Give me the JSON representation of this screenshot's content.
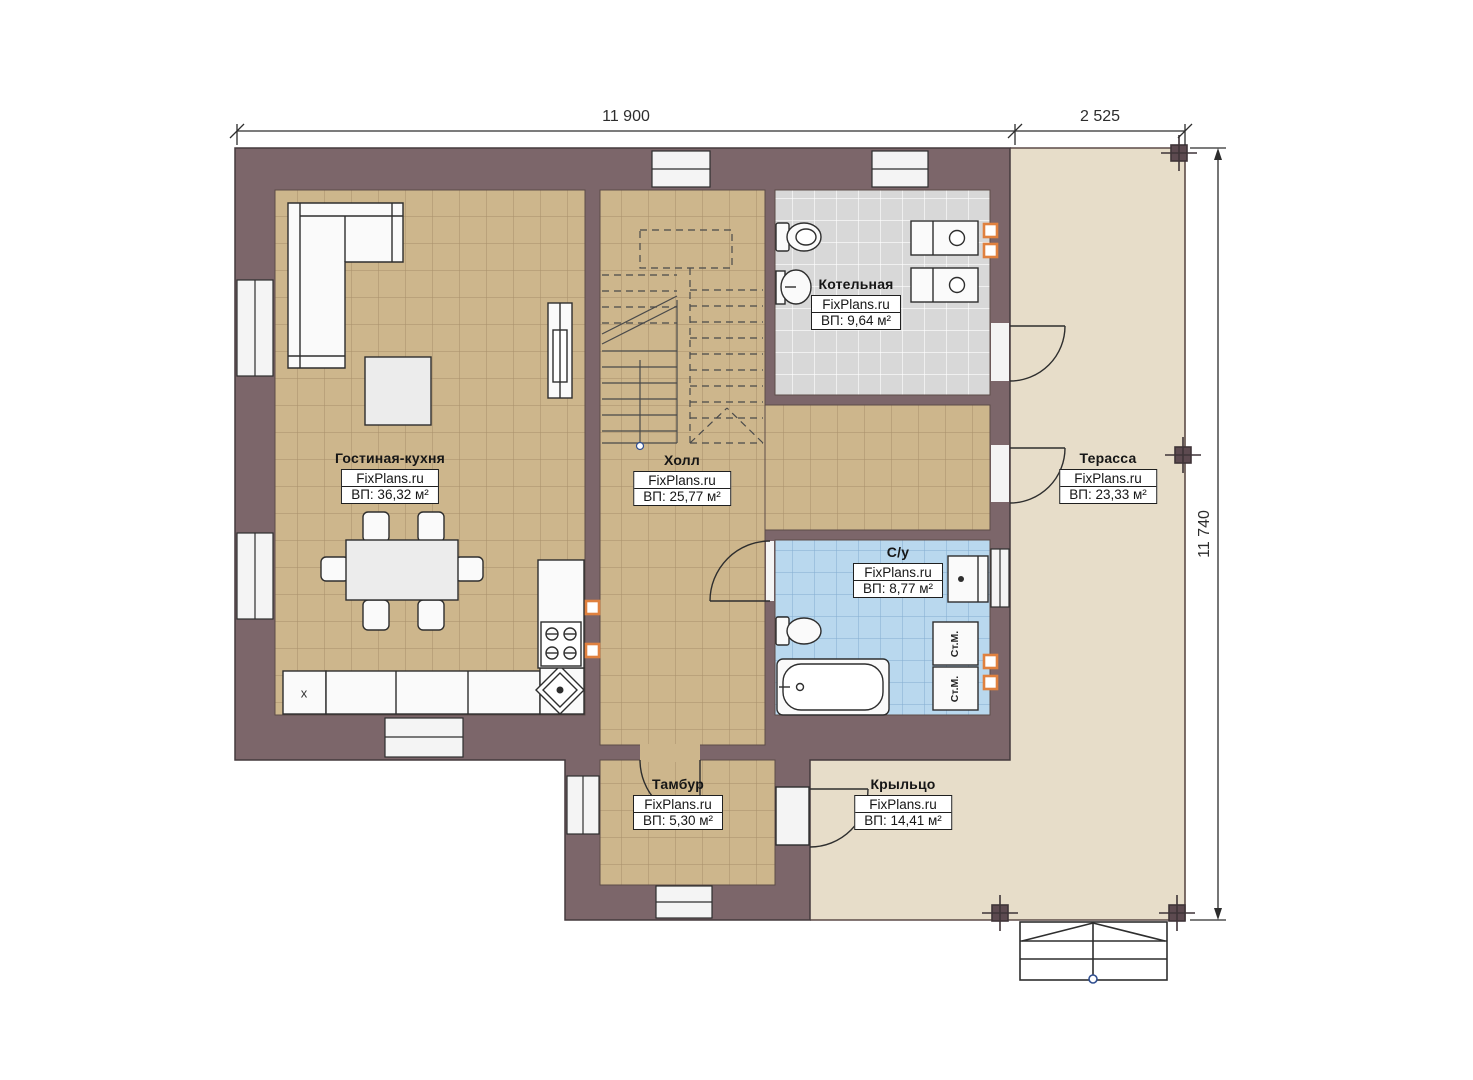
{
  "dims": {
    "main_width": "11 900",
    "terrace_width": "2 525",
    "height": "11 740"
  },
  "rooms": {
    "living": {
      "name": "Гостиная-кухня",
      "brand": "FixPlans.ru",
      "area": "ВП: 36,32 м²"
    },
    "hall": {
      "name": "Холл",
      "brand": "FixPlans.ru",
      "area": "ВП: 25,77 м²"
    },
    "boiler": {
      "name": "Котельная",
      "brand": "FixPlans.ru",
      "area": "ВП: 9,64 м²"
    },
    "terrace": {
      "name": "Терасса",
      "brand": "FixPlans.ru",
      "area": "ВП: 23,33 м²"
    },
    "bathroom": {
      "name": "С/у",
      "brand": "FixPlans.ru",
      "area": "ВП: 8,77 м²"
    },
    "vestibule": {
      "name": "Тамбур",
      "brand": "FixPlans.ru",
      "area": "ВП: 5,30 м²"
    },
    "porch": {
      "name": "Крыльцо",
      "brand": "FixPlans.ru",
      "area": "ВП: 14,41 м²"
    }
  },
  "marks": {
    "washer": "Ст.М.",
    "fridge": "x"
  },
  "colors": {
    "wall": "#7c666a",
    "floor_tan": "#cdb68c",
    "floor_gray": "#d8d8d8",
    "floor_blue": "#b9d8ee",
    "terrace": "#e7ddc9",
    "outlet": "#e0813f"
  }
}
